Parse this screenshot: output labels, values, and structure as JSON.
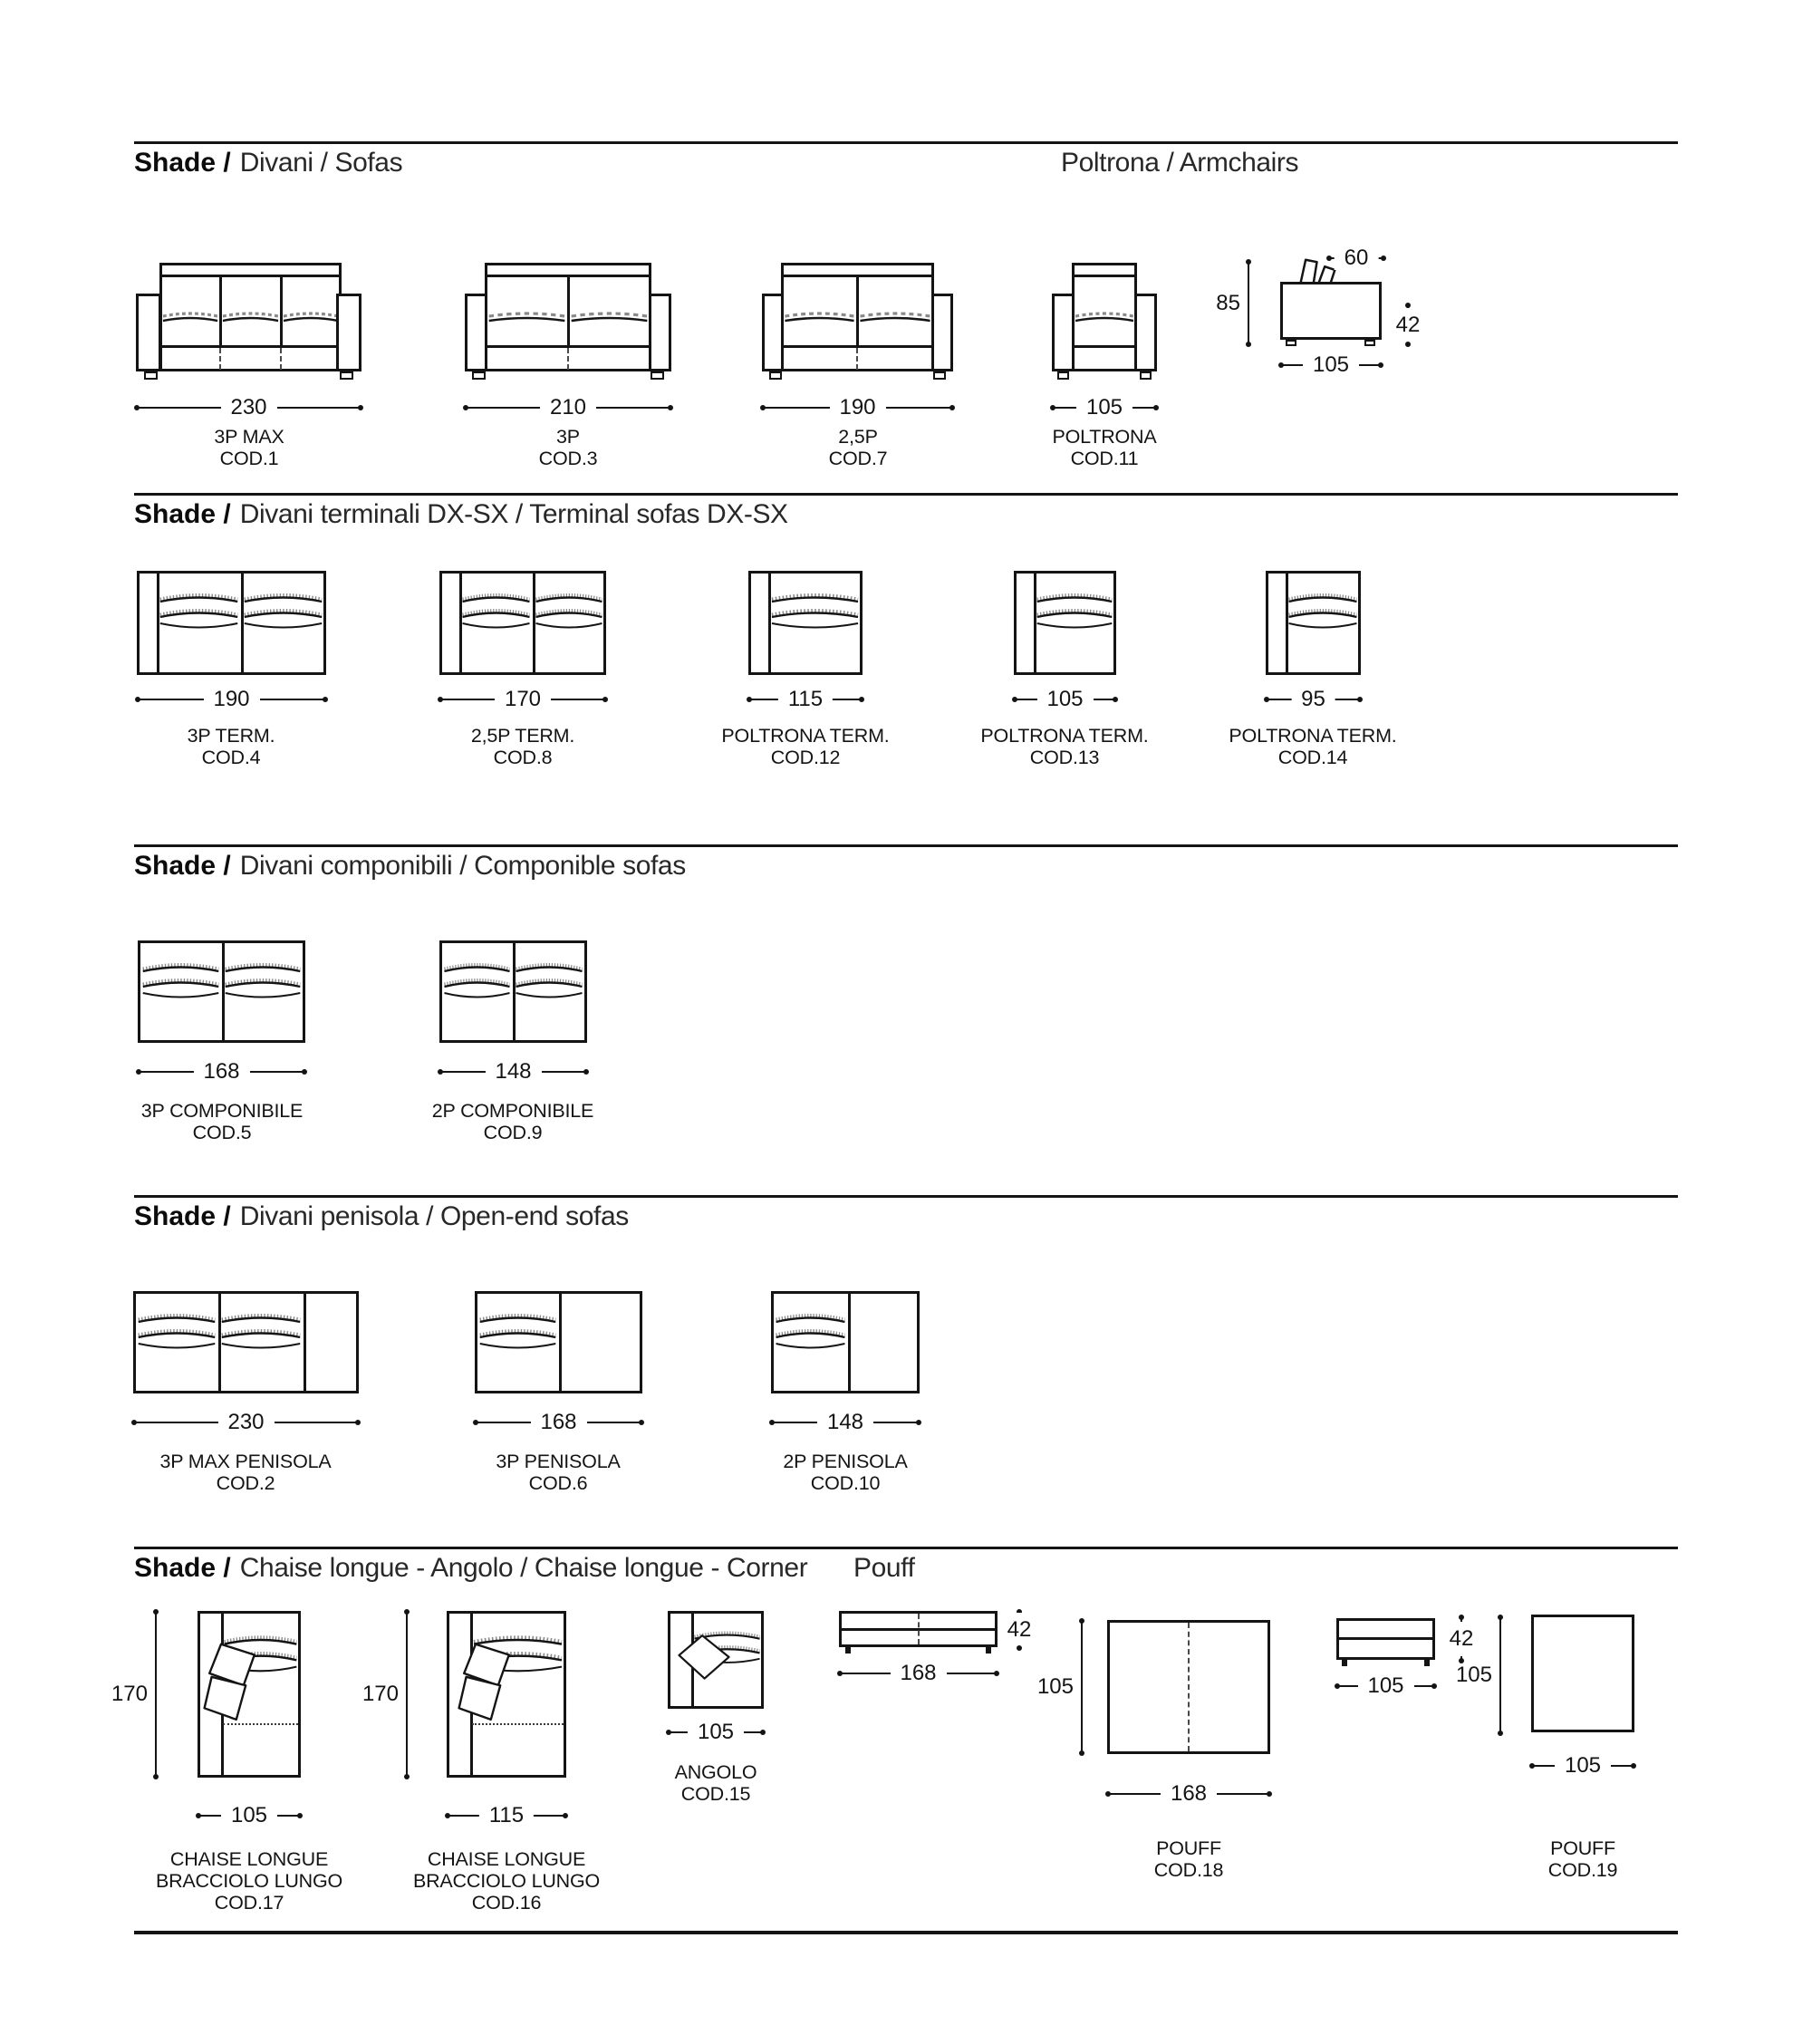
{
  "sections": {
    "s1": {
      "brand": "Shade /",
      "title": "Divani  / Sofas",
      "right_title": "Poltrona / Armchairs"
    },
    "s2": {
      "brand": "Shade /",
      "title": "Divani terminali DX-SX  / Terminal sofas DX-SX"
    },
    "s3": {
      "brand": "Shade /",
      "title": "Divani componibili / Componible sofas"
    },
    "s4": {
      "brand": "Shade /",
      "title": "Divani penisola / Open-end sofas"
    },
    "s5": {
      "brand": "Shade /",
      "title": "Chaise longue - Angolo / Chaise longue - Corner",
      "right_title": "Pouff"
    }
  },
  "items": {
    "cod1": {
      "line1": "3P MAX",
      "line2": "COD.1",
      "dim": "230"
    },
    "cod3": {
      "line1": "3P",
      "line2": "COD.3",
      "dim": "210"
    },
    "cod7": {
      "line1": "2,5P",
      "line2": "COD.7",
      "dim": "190"
    },
    "cod11": {
      "line1": "POLTRONA",
      "line2": "COD.11",
      "dim": "105"
    },
    "armchair_side": {
      "height": "85",
      "back_depth": "60",
      "seat_height": "42",
      "depth": "105"
    },
    "cod4": {
      "line1": "3P TERM.",
      "line2": "COD.4",
      "dim": "190"
    },
    "cod8": {
      "line1": "2,5P TERM.",
      "line2": "COD.8",
      "dim": "170"
    },
    "cod12": {
      "line1": "POLTRONA TERM.",
      "line2": "COD.12",
      "dim": "115"
    },
    "cod13": {
      "line1": "POLTRONA TERM.",
      "line2": "COD.13",
      "dim": "105"
    },
    "cod14": {
      "line1": "POLTRONA TERM.",
      "line2": "COD.14",
      "dim": "95"
    },
    "cod5": {
      "line1": "3P COMPONIBILE",
      "line2": "COD.5",
      "dim": "168"
    },
    "cod9": {
      "line1": "2P COMPONIBILE",
      "line2": "COD.9",
      "dim": "148"
    },
    "cod2": {
      "line1": "3P MAX PENISOLA",
      "line2": "COD.2",
      "dim": "230"
    },
    "cod6": {
      "line1": "3P PENISOLA",
      "line2": "COD.6",
      "dim": "168"
    },
    "cod10": {
      "line1": "2P PENISOLA",
      "line2": "COD.10",
      "dim": "148"
    },
    "cod17": {
      "line1": "CHAISE LONGUE",
      "line2": "BRACCIOLO LUNGO",
      "line3": "COD.17",
      "dim": "105",
      "vdim": "170"
    },
    "cod16": {
      "line1": "CHAISE LONGUE",
      "line2": "BRACCIOLO LUNGO",
      "line3": "COD.16",
      "dim": "115",
      "vdim": "170"
    },
    "cod15": {
      "line1": "ANGOLO",
      "line2": "COD.15",
      "dim": "105"
    },
    "cod18": {
      "line1": "POUFF",
      "line2": "COD.18",
      "dim": "168",
      "depth": "105",
      "height": "42"
    },
    "cod19": {
      "line1": "POUFF",
      "line2": "COD.19",
      "dim": "105",
      "depth": "105",
      "height": "42"
    }
  },
  "colors": {
    "ink": "#141414",
    "paper": "#ffffff",
    "soft": "#8a8a8a"
  }
}
